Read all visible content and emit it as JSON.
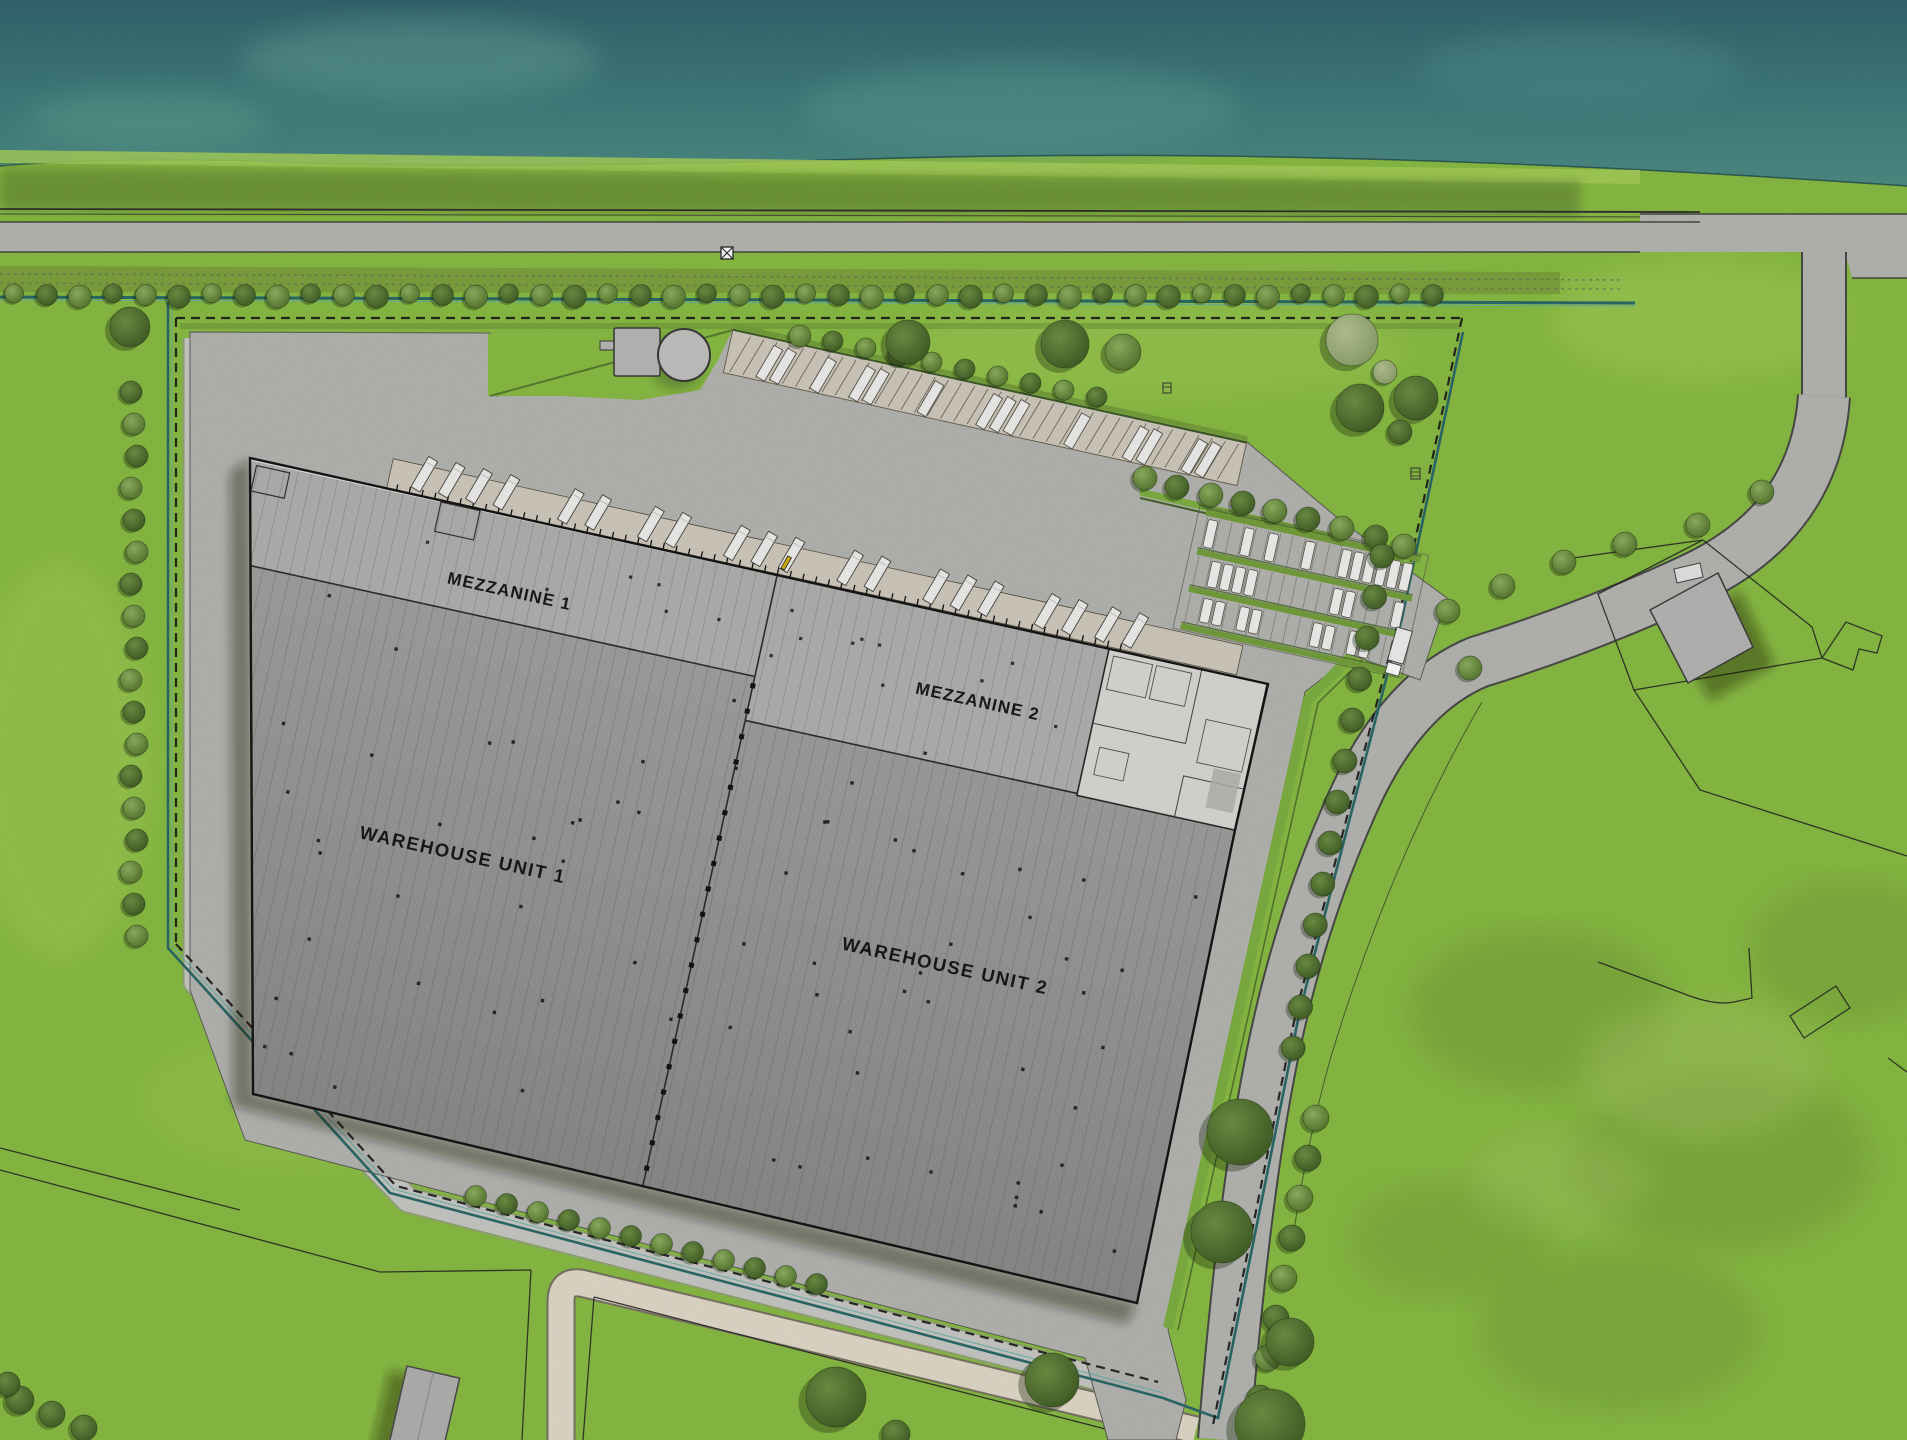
{
  "plan": {
    "type": "logistics-park-site-plan",
    "view": "aerial-plan",
    "building": {
      "units": [
        {
          "id": "mezzanine-1",
          "label": "MEZZANINE 1"
        },
        {
          "id": "mezzanine-2",
          "label": "MEZZANINE 2"
        },
        {
          "id": "warehouse-unit-1",
          "label": "WAREHOUSE UNIT 1"
        },
        {
          "id": "warehouse-unit-2",
          "label": "WAREHOUSE UNIT 2"
        }
      ]
    }
  },
  "colors": {
    "grass": "#8abd44",
    "grass_light": "#a6d05a",
    "grass_dark": "#6f9a38",
    "grass_sage": "#a8c668",
    "water": "#3a6f78",
    "water_light": "#63a095",
    "hedge": "#6e9539",
    "hedge_dark": "#44622a",
    "hedge_bright": "#7fb043",
    "road": "#b7b8b4",
    "road_edge": "#3c3c3a",
    "court": "#b6b7b3",
    "gravel": "#c9cac6",
    "dock_strip": "#d2cbbf",
    "path": "#e3dbca",
    "path_edge": "#7a7465",
    "roof_mezz": "#b2b2b0",
    "roof_top": "#a2a2a0",
    "roof_bottom": "#8b8b89",
    "office": "#dbdad6",
    "outline": "#161616",
    "trailer": "#f0f0ee",
    "car": "#f2f2f0",
    "tank": "#c3c3c1",
    "swale": "#2c6a6a",
    "swale_light": "#67b0ac",
    "rail": "#30302e",
    "parcel_line": "#222222",
    "label": "#191919",
    "shadow": "rgba(25,32,15,0.38)",
    "tree_mid_in": "#8fb35f",
    "tree_mid_out": "#54742f",
    "tree_dark_in": "#6f9144",
    "tree_dark_out": "#3f5c26",
    "tree_light_in": "#b9c694",
    "tree_light_out": "#8a9e6a",
    "gate_yellow": "#d4b516"
  }
}
